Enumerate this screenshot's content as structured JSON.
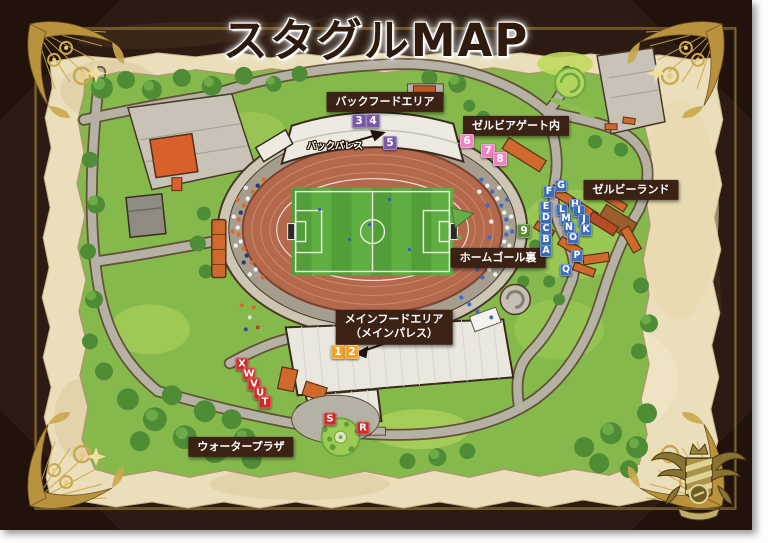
{
  "title": "スタグルMAP",
  "palette": {
    "frame": "#2c1b12",
    "gold": "#bb9440",
    "parchment": "#eadfba",
    "label_bg": "#3b2215",
    "label_text": "#ffffff"
  },
  "legend_colors": {
    "purple": "#7a58a8",
    "pink": "#ef83c2",
    "blue": "#3e6cb6",
    "green": "#5d8b37",
    "orange": "#f0a32a",
    "red": "#cf2b26"
  },
  "area_labels": [
    {
      "id": "back-food-area",
      "style": "box",
      "x": 385,
      "y": 102,
      "lines": [
        "バックフードエリア"
      ]
    },
    {
      "id": "zelvia-gate",
      "style": "box",
      "x": 516,
      "y": 126,
      "lines": [
        "ゼルビアゲート内"
      ]
    },
    {
      "id": "zelvy-land",
      "style": "box",
      "x": 631,
      "y": 190,
      "lines": [
        "ゼルビーランド"
      ]
    },
    {
      "id": "home-goal-back",
      "style": "box",
      "x": 498,
      "y": 258,
      "lines": [
        "ホームゴール裏"
      ]
    },
    {
      "id": "main-food-area",
      "style": "box",
      "x": 394,
      "y": 327,
      "lines": [
        "メインフードエリア",
        "（メインパレス）"
      ]
    },
    {
      "id": "water-plaza",
      "style": "box",
      "x": 241,
      "y": 447,
      "lines": [
        "ウォータープラザ"
      ]
    },
    {
      "id": "back-palace",
      "style": "plain",
      "x": 335,
      "y": 147,
      "lines": [
        "バックパレス"
      ]
    }
  ],
  "markers": [
    {
      "label": "3",
      "group": "purple",
      "x": 359,
      "y": 121
    },
    {
      "label": "4",
      "group": "purple",
      "x": 373,
      "y": 121
    },
    {
      "label": "5",
      "group": "purple",
      "x": 390,
      "y": 143
    },
    {
      "label": "6",
      "group": "pink",
      "x": 467,
      "y": 141
    },
    {
      "label": "7",
      "group": "pink",
      "x": 488,
      "y": 151
    },
    {
      "label": "8",
      "group": "pink",
      "x": 500,
      "y": 159
    },
    {
      "label": "9",
      "group": "green",
      "x": 524,
      "y": 231
    },
    {
      "label": "1",
      "group": "orange",
      "x": 338,
      "y": 352
    },
    {
      "label": "2",
      "group": "orange",
      "x": 352,
      "y": 352
    },
    {
      "label": "G",
      "group": "blue",
      "x": 561,
      "y": 186
    },
    {
      "label": "F",
      "group": "blue",
      "x": 549,
      "y": 192
    },
    {
      "label": "E",
      "group": "blue",
      "x": 546,
      "y": 207
    },
    {
      "label": "D",
      "group": "blue",
      "x": 546,
      "y": 218
    },
    {
      "label": "C",
      "group": "blue",
      "x": 546,
      "y": 229
    },
    {
      "label": "B",
      "group": "blue",
      "x": 546,
      "y": 240
    },
    {
      "label": "A",
      "group": "blue",
      "x": 546,
      "y": 251
    },
    {
      "label": "H",
      "group": "blue",
      "x": 575,
      "y": 205
    },
    {
      "label": "I",
      "group": "blue",
      "x": 579,
      "y": 211
    },
    {
      "label": "J",
      "group": "blue",
      "x": 584,
      "y": 220
    },
    {
      "label": "K",
      "group": "blue",
      "x": 586,
      "y": 230
    },
    {
      "label": "L",
      "group": "blue",
      "x": 562,
      "y": 210
    },
    {
      "label": "M",
      "group": "blue",
      "x": 566,
      "y": 219
    },
    {
      "label": "N",
      "group": "blue",
      "x": 569,
      "y": 228
    },
    {
      "label": "O",
      "group": "blue",
      "x": 573,
      "y": 238
    },
    {
      "label": "P",
      "group": "blue",
      "x": 577,
      "y": 256
    },
    {
      "label": "Q",
      "group": "blue",
      "x": 566,
      "y": 270
    },
    {
      "label": "X",
      "group": "red",
      "x": 242,
      "y": 364
    },
    {
      "label": "W",
      "group": "red",
      "x": 249,
      "y": 374
    },
    {
      "label": "V",
      "group": "red",
      "x": 254,
      "y": 384
    },
    {
      "label": "U",
      "group": "red",
      "x": 260,
      "y": 393
    },
    {
      "label": "T",
      "group": "red",
      "x": 265,
      "y": 402
    },
    {
      "label": "S",
      "group": "red",
      "x": 330,
      "y": 419
    },
    {
      "label": "R",
      "group": "red",
      "x": 363,
      "y": 428
    }
  ]
}
